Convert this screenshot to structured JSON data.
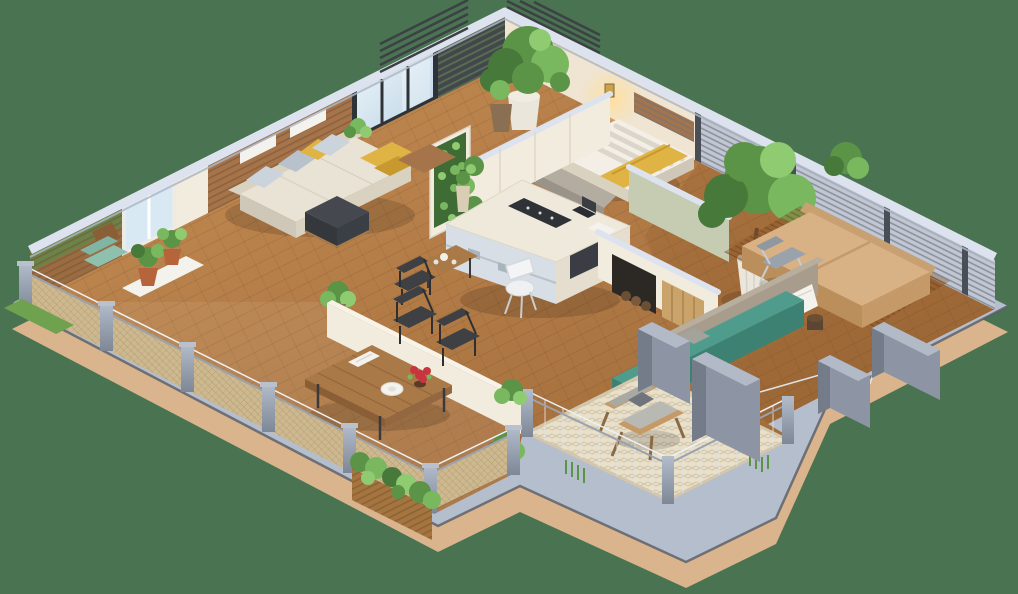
{
  "scene": {
    "type": "isometric-3d-floor-plan",
    "projection": "isometric cutaway, top-down 3D",
    "description": "3D isometric cutaway floor plan of an apartment with living room, kitchen island, two bedrooms, hallway, wrap-around wooden terrace with dining table, and a patio with armchair and teal bench, on a plain green background",
    "background_color": "#4a7351"
  },
  "palette": {
    "bg": "#4a7351",
    "plinthTop": "#b5becc",
    "plinthSide": "#d9b48d",
    "plinthEdge": "#575d66",
    "floorWood1": "#c68e55",
    "floorWood2": "#9a6535",
    "capLight": "#dde3ee",
    "capShade": "#aeb6c6",
    "wallCream": "#f2ecdf",
    "wallWarm": "#efe5d2",
    "wallSliver": "#f7f3e9",
    "slatWood": "#a5744a",
    "louverDark": "#42474b",
    "frameDark": "#2e3338",
    "whiteFrame": "#eceae4",
    "glassFlat": "#d9e9f3",
    "louverLight": "#c2c8d3",
    "postDark": "#4a4f57",
    "railPost": "#8e97a6",
    "railPostLight": "#b3bcca",
    "mesh": "#cdb88f",
    "sofa": "#e9e3d5",
    "sofaShade": "#d9d2c1",
    "sofaSide": "#cfc8b8",
    "pillowGray": "#b8c2cc",
    "pillowGray2": "#cbd4dc",
    "yellow": "#dfb445",
    "yellowDeep": "#c7992e",
    "ottoman": "#45494f",
    "ottomanDark": "#34383d",
    "islandTop": "#efe9dc",
    "islandFace": "#e5ddcd",
    "cooktop": "#2f3338",
    "ovenDark": "#3a3e44",
    "glassShelf": "#d7dee6",
    "sage": "#c6ccb2",
    "tanBed": "#d8b184",
    "tanBedShade": "#bb8f5c",
    "tanBedSide": "#c59a68",
    "headboardTan": "#c9a072",
    "teal": "#4f9c8d",
    "tealDark": "#3d8172",
    "tealCushion": "#7fb5a2",
    "concrete": "#a89d8d",
    "pillarFace": "#8d95a4",
    "pillarSide": "#747c8a",
    "pillarTop": "#b2bac8",
    "rug": "#e9e0cb",
    "woodTable": "#a97948",
    "woodTableDark": "#8a5f36",
    "chairDark": "#3f4043",
    "green1": "#47793a",
    "green2": "#5c9447",
    "green3": "#79b85e",
    "green4": "#8fcb70",
    "potWhite": "#eae6dc",
    "potTerra": "#b5643c",
    "trunk": "#6b4a2f",
    "white": "#f4f2ec",
    "red": "#c8353f",
    "stone": "#b3aca0",
    "glow": "#ffd98a"
  },
  "rooms": [
    {
      "id": "living-room",
      "label": "Living room",
      "items": [
        "sectional sofa",
        "gray pillows",
        "yellow throw pillows",
        "dark ottoman",
        "wood slat accent wall",
        "wall shelves",
        "picture window",
        "floor plant"
      ]
    },
    {
      "id": "kitchen",
      "label": "Kitchen",
      "items": [
        "island with cooktop",
        "glass display shelves",
        "built-in oven",
        "white stool",
        "vertical garden panel",
        "vase",
        "laptop",
        "cabinet wall"
      ]
    },
    {
      "id": "dining-nook",
      "label": "Dining nook",
      "items": [
        "small wood table",
        "tea set",
        "dark chair"
      ]
    },
    {
      "id": "bedroom-small",
      "label": "Small bedroom",
      "items": [
        "bed with white ribbed pillows",
        "yellow blanket",
        "wood headboard panel",
        "glowing wall sconce",
        "stone foot bench",
        "two potted trees"
      ]
    },
    {
      "id": "bedroom-master",
      "label": "Master bedroom",
      "items": [
        "tan platform bed",
        "wood slat rug",
        "lounge chair",
        "potted tree",
        "round shrub",
        "side stool",
        "louvered privacy screens"
      ]
    },
    {
      "id": "hallway",
      "label": "Hallway",
      "items": [
        "storage alcove with firewood",
        "wood door panel",
        "sage green accent wall"
      ]
    },
    {
      "id": "terrace",
      "label": "Terrace deck",
      "items": [
        "dining table",
        "two black chairs",
        "plate",
        "red flowers",
        "white book",
        "half wall",
        "mesh railing with gray posts",
        "corner planter box",
        "grass mat",
        "teal floor cushion",
        "white tray with terracotta plants"
      ]
    },
    {
      "id": "patio",
      "label": "Patio",
      "items": [
        "woven rug",
        "wood armchair with gray cushions",
        "dark throw pillow",
        "teal bench",
        "gray pillows",
        "white towel",
        "wire railing",
        "grass planters",
        "concrete pillars"
      ]
    }
  ]
}
